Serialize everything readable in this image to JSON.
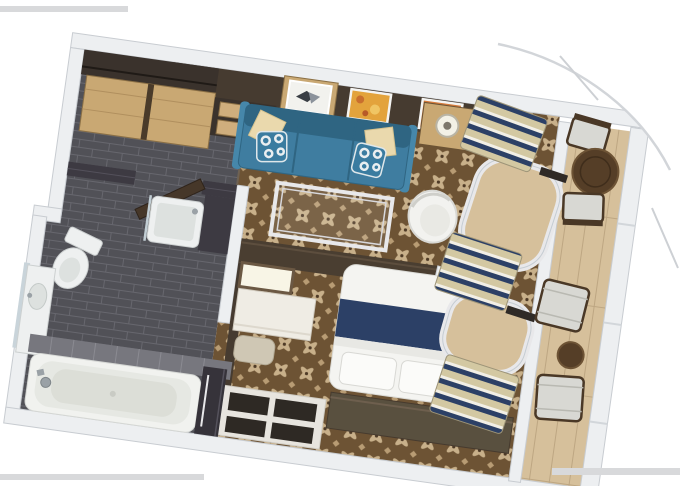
{
  "canvas": {
    "width": 680,
    "height": 486
  },
  "scene": {
    "type": "3d-floorplan-rendering",
    "rooms": [
      "entry-hall",
      "bathroom",
      "living-room",
      "bedroom",
      "balcony"
    ],
    "objects": [
      "wardrobe",
      "upper-cabinet",
      "drawer-chest",
      "artwork-bird",
      "artwork-yellow",
      "artwork-orange",
      "teal-sofa",
      "throw-pillows",
      "glass-coffee-table",
      "side-table-lamp",
      "white-tub-chair",
      "tv-partition",
      "vanity-mirror",
      "vanity-desk",
      "stool",
      "double-bed",
      "bed-runner",
      "pillows",
      "credenza",
      "open-shelf-unit",
      "striped-linen-stacks",
      "curved-window-frames",
      "balcony-bistro-table",
      "balcony-chairs",
      "balcony-lounge-chairs",
      "balcony-side-table",
      "toilet",
      "shower-tray",
      "left-vanity-sink",
      "bathtub",
      "towel-niche",
      "open-doors"
    ]
  },
  "palette": {
    "page_bg": "#ffffff",
    "wall": "#edeff1",
    "wall_stroke": "#c8ccd1",
    "carpet_base": "#6d5334",
    "carpet_motif": "#c8b08a",
    "carpet_motif2": "#b89c74",
    "tile_base": "#515157",
    "tile_line": "#67676e",
    "deck_base": "#d6c09b",
    "deck_line": "#b7a07c",
    "accent_wall": "#463b30",
    "wood_light": "#c9a873",
    "wood_seam": "#8a6f45",
    "wood_dark": "#3a322c",
    "drawer_front": "#cfae7d",
    "sofa": "#3f7da0",
    "sofa_dark": "#2f6582",
    "sofa_arm": "#4687aa",
    "pillow_cream": "#ead9ad",
    "pillow_teal": "#3a7ca0",
    "navy": "#2c4066",
    "linen_beige": "#d3c8a2",
    "linen_white": "#f2efe6",
    "bed_white": "#f4f4f1",
    "credenza": "#59503f",
    "door_wood": "#463729",
    "fixture_white": "#eef0f0",
    "fixture_inner": "#dde1df",
    "fixture_stroke": "#ccd0d0",
    "bath_wall_dark": "#3d3a42",
    "bath_wall_gray": "#77777e",
    "table_wood": "#553e27",
    "table_rim": "#6d5335",
    "chair_cushion": "#d8d8d3",
    "chair_frame": "#4a3826",
    "glass_frame": "#e8e8ea",
    "frame_edge": "#d4d8dc",
    "art_yellow": "#e3a33c",
    "art_orange": "#d77b3a",
    "partition": "#4a3e31",
    "photo_edge": "#d8d9db",
    "chrome": "#9aa1a6",
    "mirror_glass": "#c9d4da",
    "mirror_bright": "#f8f5e6"
  }
}
